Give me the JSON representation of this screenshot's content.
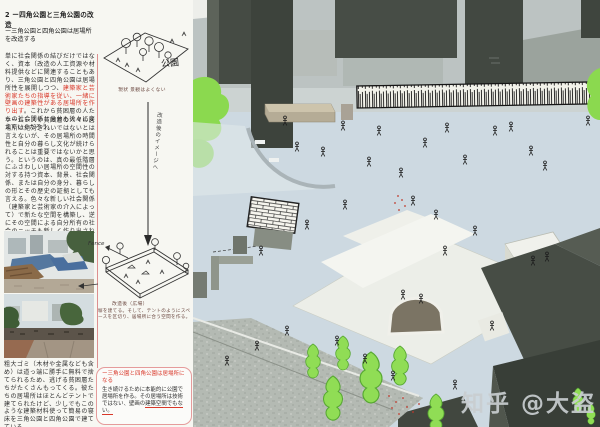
{
  "header": {
    "title": "2 ー四角公園と三角公園の改造",
    "subtitle": "ー三角公園と四角公園は居場所を改造する"
  },
  "paragraphs": {
    "p1_a": "単に社会関係の結びだけではなく、資本（改造の人工資源や材料提供などに関連することもあり、三角公園と四角公園は居場所性を展開しつつ、",
    "p1_red": "建築家と芸術家たちの指導を従い、一緒に壁画の建築性がある居場所を作り出す",
    "p1_b": "。これから貧困層の人たちの社会関係と身分も徐々に変えていくだろう。",
    "p2": "ホームレスや貧困層の人々の居場所は絶対きれいではないとは言えないが、その居場所の時間性と自分の暮らし文化が続けられることは重要ではないかと思う。というのは、真の最低階層にふさわしい居場所の空間性の対する持つ資本、背景、社会関係、または自分の身分、暮らしの形とその歴史の証拠としても言える。色々な新しい社会関係（建築家と芸術家の介入によって）で新たな空間を構築し、逆にその空間による自分所有の社会のニッチも新しく作り出されるだろう。",
    "p3": "粗大ゴミ（木材や金属なども含め）は道っ端に勝手に無料で捨てられるため、逃げる貧困層たちがたくさんもってくる。彼たちの居場所はほとんどテントで建てられたけど、少しでもこのような建築材料使って簡易の寝床を三角公園と四角公園で建てている。"
  },
  "sketches": {
    "park_label": "公園",
    "park_caption": "現状 景観はよくない",
    "arrow_note": "改造後のイメージへ",
    "fence_label": "Fence",
    "plaza_caption": "改造後（広場）",
    "plaza_note": "塀を建てる。そして、テントのようにスペースを区切り、居場所に合う空間を作る。"
  },
  "bubble": {
    "heading": "ー三角公園と四角公園は居場所になる",
    "body": "生き続けるために本能的に公園で居場所を作る。その居場所は技術ではない、壁画の",
    "body_underline": "建築空間でもない。"
  },
  "model_photo": {
    "description": "architectural-model-aerial-photo",
    "watermark": "知乎 @大盗"
  },
  "colors": {
    "accent_red": "#d9382a",
    "annotation_pink_line": "#dc8f8f",
    "ground_blue": "#cdd9e1",
    "tree_green": "#8bd94f",
    "dark_building": "#454b44",
    "watermark_gray": "#c9ced0"
  }
}
